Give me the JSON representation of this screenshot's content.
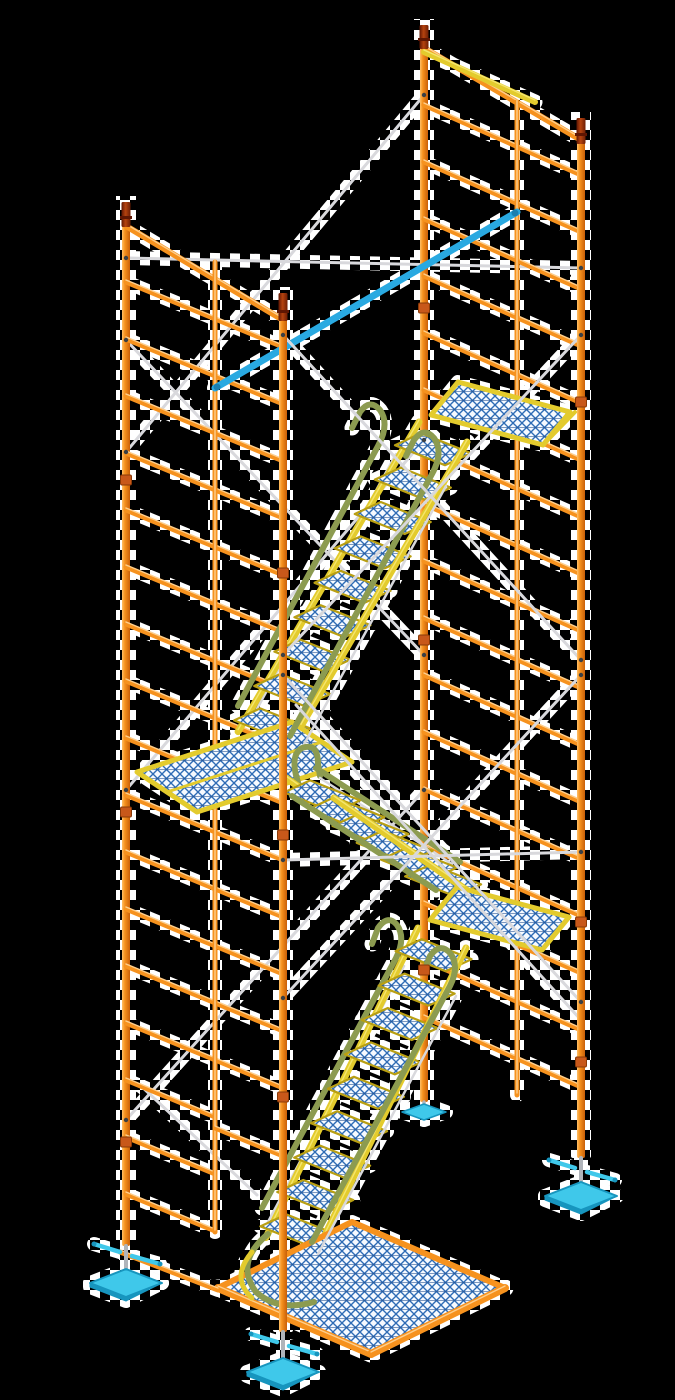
{
  "scene": {
    "type": "3d-product-render",
    "subject": "Frame scaffolding stair tower with internal zig-zag stair units",
    "view": "isometric three-quarter view",
    "background_color": "#000000",
    "halo_effect": "white transparency-checkerboard fringe hugging the structure",
    "levels": 3,
    "stair_flights": 3,
    "landing_platforms": 3,
    "base_platform": 1,
    "posts": 4,
    "base_jacks": 4,
    "coupling_pins": 4
  },
  "palette": {
    "bg": "#000000",
    "halo": "#ffffff",
    "orange": "#f6921e",
    "orangeHi": "#ffd9a0",
    "orangeDark": "#c95f08",
    "orangeLight": "#ffbf66",
    "yellow": "#e3cb2d",
    "yellowHi": "#f7ea7a",
    "yellowDark": "#b99f12",
    "olive": "#8c9b50",
    "oliveDark": "#6d7a3a",
    "silver": "#d8d8dc",
    "silverDark": "#a9abb0",
    "blueBrace": "#29a9e1",
    "blueBraceDark": "#1a7fb0",
    "meshBlue": "#2e6cb5",
    "meshNavy": "#1c4a8c",
    "meshBg": "#f6faff",
    "cyan": "#3fc8ea",
    "cyanDark": "#1795be",
    "pin": "#8c2a06",
    "pinHi": "#b5430f",
    "pinDark": "#5f1602",
    "clamp": "#3a3f45",
    "collar": "#c8581a",
    "collarDark": "#8a3a08"
  },
  "components": [
    {
      "name": "vertical-posts",
      "count": 4,
      "color_key": "orange",
      "note": "tubular legs of two end frames"
    },
    {
      "name": "frame-rungs",
      "color_key": "orange",
      "note": "ladder rungs on both end frames"
    },
    {
      "name": "walkthrough-door",
      "color_key": "orange",
      "note": "open doorway in lower left frame"
    },
    {
      "name": "coupling-pins",
      "count": 4,
      "color_key": "pin",
      "note": "dark red stack pins on top of each post"
    },
    {
      "name": "cross-braces",
      "color_key": "silver",
      "note": "thin white/silver diagonal X braces"
    },
    {
      "name": "diagonal-tube-brace",
      "color_key": "blueBrace",
      "note": "single blue tube brace near top"
    },
    {
      "name": "stair-stringers",
      "color_key": "yellow",
      "note": "yellow channel stringers of all flights"
    },
    {
      "name": "stair-treads",
      "color_key": "meshBlue",
      "note": "expanded-metal mesh treads, blue over white"
    },
    {
      "name": "handrails",
      "color_key": "olive",
      "note": "olive-green looped handrails along flights"
    },
    {
      "name": "inner-handrails",
      "color_key": "silver",
      "note": "thin silver rails beside green rails"
    },
    {
      "name": "landing-platforms",
      "count": 3,
      "color_key": "yellow",
      "note": "yellow-framed mesh landings"
    },
    {
      "name": "base-deck-platform",
      "color_key": "orange",
      "note": "orange-framed mesh deck at ground level"
    },
    {
      "name": "screw-jack-bases",
      "count": 4,
      "color_key": "cyan",
      "note": "cyan base plates with wing-nut screw jacks"
    }
  ]
}
